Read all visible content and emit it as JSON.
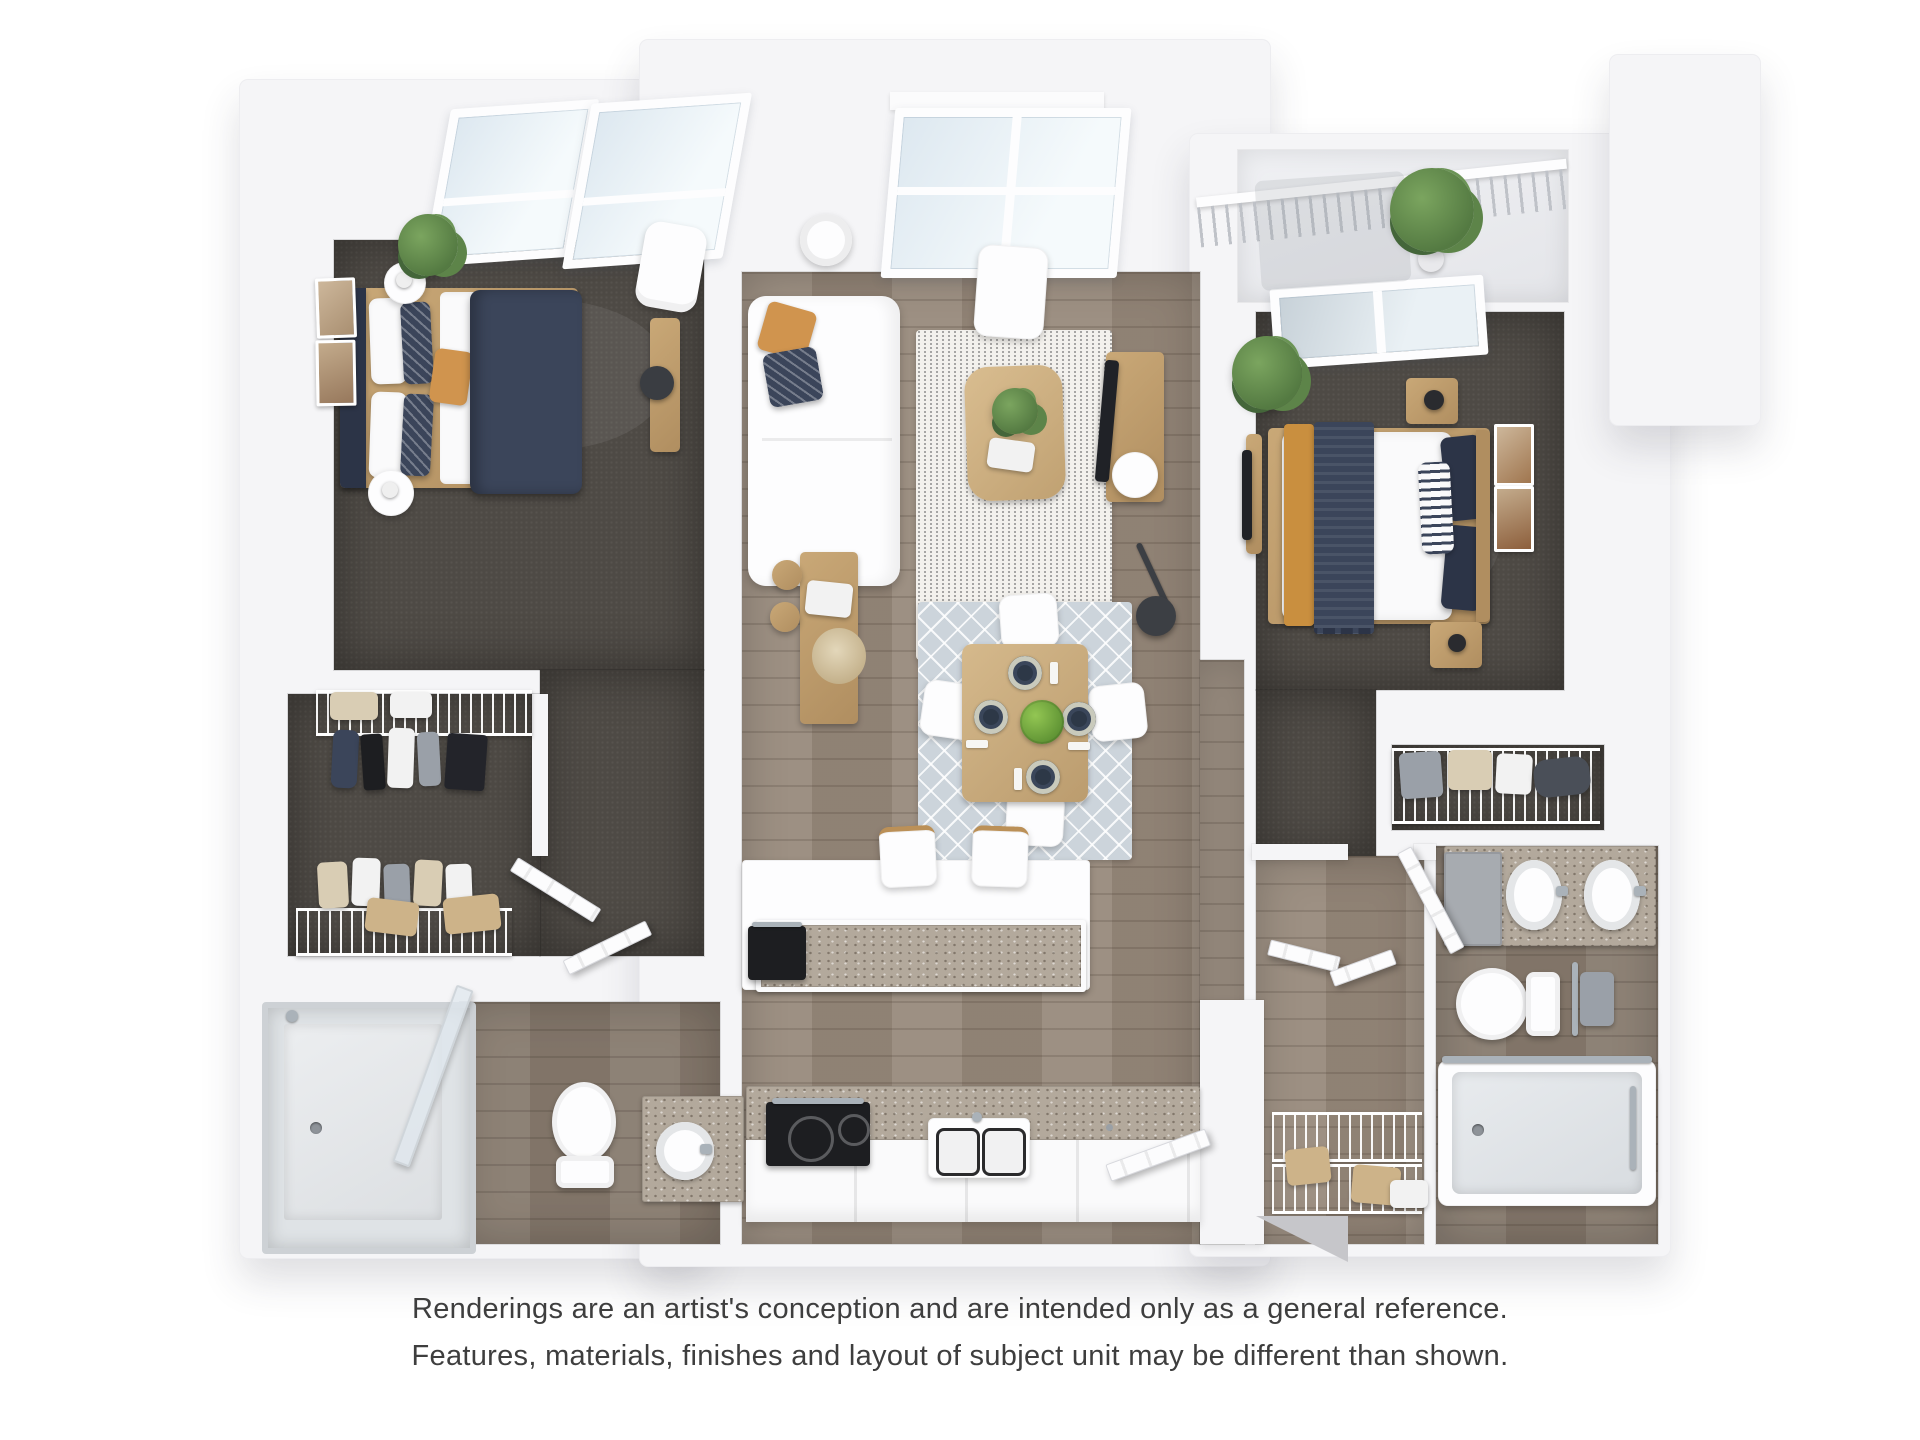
{
  "disclaimer": {
    "line1": "Renderings are an artist's conception and are intended only as a general reference.",
    "line2": "Features, materials, finishes and layout of subject unit may be different than shown."
  },
  "floor_plan": {
    "style": "photorealistic 3D top-down apartment rendering, no text labels",
    "rooms": [
      {
        "name": "bedroom-1",
        "floor": "dark carpet",
        "features": [
          "queen-bed",
          "navy-duvet",
          "orange-accent-pillow",
          "two-round-nightstands",
          "table-lamps",
          "two-wall-art-frames",
          "potted-plant",
          "armchair",
          "desk",
          "desk-chair",
          "skylight-window-bay"
        ]
      },
      {
        "name": "walk-in-closet",
        "floor": "dark carpet",
        "features": [
          "wire-shelving-top",
          "wire-shelving-bottom",
          "hanging-clothes",
          "storage-boxes"
        ]
      },
      {
        "name": "bathroom-1",
        "floor": "wood",
        "features": [
          "glass-shower",
          "toilet",
          "single-vanity-round-sink"
        ]
      },
      {
        "name": "living-room",
        "floor": "wood",
        "features": [
          "white-sectional-sofa",
          "orange-pillow",
          "navy-patterned-pillow",
          "speckled-area-rug",
          "wood-coffee-table",
          "plant-centerpiece",
          "book",
          "lounge-chair",
          "drum-floor-lamp",
          "media-console",
          "tv",
          "round-side-table",
          "arc-floor-lamp",
          "large-window-bay"
        ]
      },
      {
        "name": "dining-area",
        "floor": "wood",
        "features": [
          "diamond-pattern-rug",
          "square-wood-table",
          "four-white-chairs",
          "four-place-settings",
          "green-apple-centerpiece",
          "sideboard",
          "dried-pampas",
          "art-book"
        ]
      },
      {
        "name": "kitchen",
        "floor": "wood",
        "features": [
          "island-granite-top",
          "two-bar-stools",
          "built-in-black-appliance",
          "granite-counter",
          "black-cooktop",
          "double-basin-sink",
          "white-cabinets"
        ]
      },
      {
        "name": "entry",
        "floor": "wood",
        "features": [
          "front-door-open",
          "wire-shelf-closet",
          "storage-boxes"
        ]
      },
      {
        "name": "bedroom-2",
        "floor": "dark carpet",
        "features": [
          "queen-bed",
          "white-duvet",
          "navy-throw-with-fringe",
          "mustard-blanket",
          "striped-pillow",
          "two-wood-nightstands",
          "two-wall-art-frames",
          "potted-plant",
          "tv-stand",
          "window-to-balcony"
        ]
      },
      {
        "name": "linen-closet",
        "floor": "dark carpet",
        "features": [
          "wire-shelving",
          "bags",
          "towels"
        ]
      },
      {
        "name": "bathroom-2",
        "floor": "wood",
        "features": [
          "double-vanity",
          "two-oval-sinks",
          "toilet",
          "towel-rail",
          "bathtub-with-glass-door"
        ]
      },
      {
        "name": "balcony",
        "floor": "concrete",
        "features": [
          "metal-slat-railing",
          "potted-palm"
        ]
      }
    ],
    "colors": {
      "wall": "#f5f5f7",
      "carpet": "#4e4a45",
      "wood": "#97897b",
      "granite": "#b3a99c",
      "navy": "#3b455a",
      "navyDark": "#2c3447",
      "orange": "#d0944e",
      "oak": "#c9a877",
      "rugBlue": "#ccd4db",
      "green": "#547a42",
      "glass": "#dde8f0",
      "chrome": "#aab2b9",
      "dark": "#1d1e21",
      "text": "#3e3e3e"
    }
  }
}
